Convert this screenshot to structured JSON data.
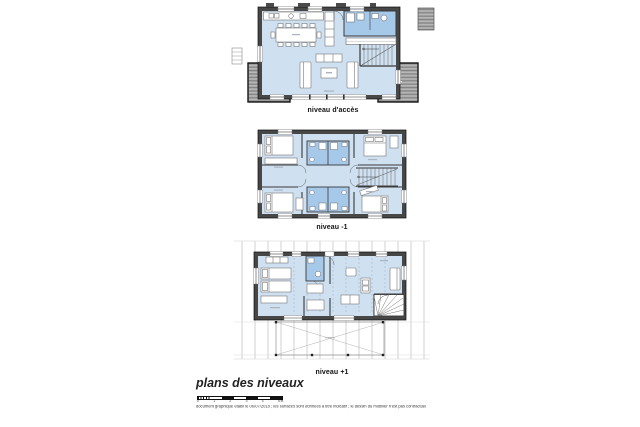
{
  "sheet": {
    "plans": [
      {
        "label": "niveau d'accès"
      },
      {
        "label": "niveau -1"
      },
      {
        "label": "niveau +1"
      }
    ],
    "footer": {
      "title": "plans des niveaux",
      "disclaimer": "document graphique établi le 06/07/2018 ; les surfaces sont données à titre indicatif ; le dessin du mobilier n'est pas contractuel",
      "scale_ticks": [
        "0",
        "1",
        "2",
        "3",
        "4",
        "5 m"
      ]
    },
    "colors": {
      "floor": "#cfe0f1",
      "wet_room": "#a6c8e9",
      "wall": "#474747",
      "terrace": "#a8a8a8",
      "rafter": "#bcbcbc"
    }
  }
}
